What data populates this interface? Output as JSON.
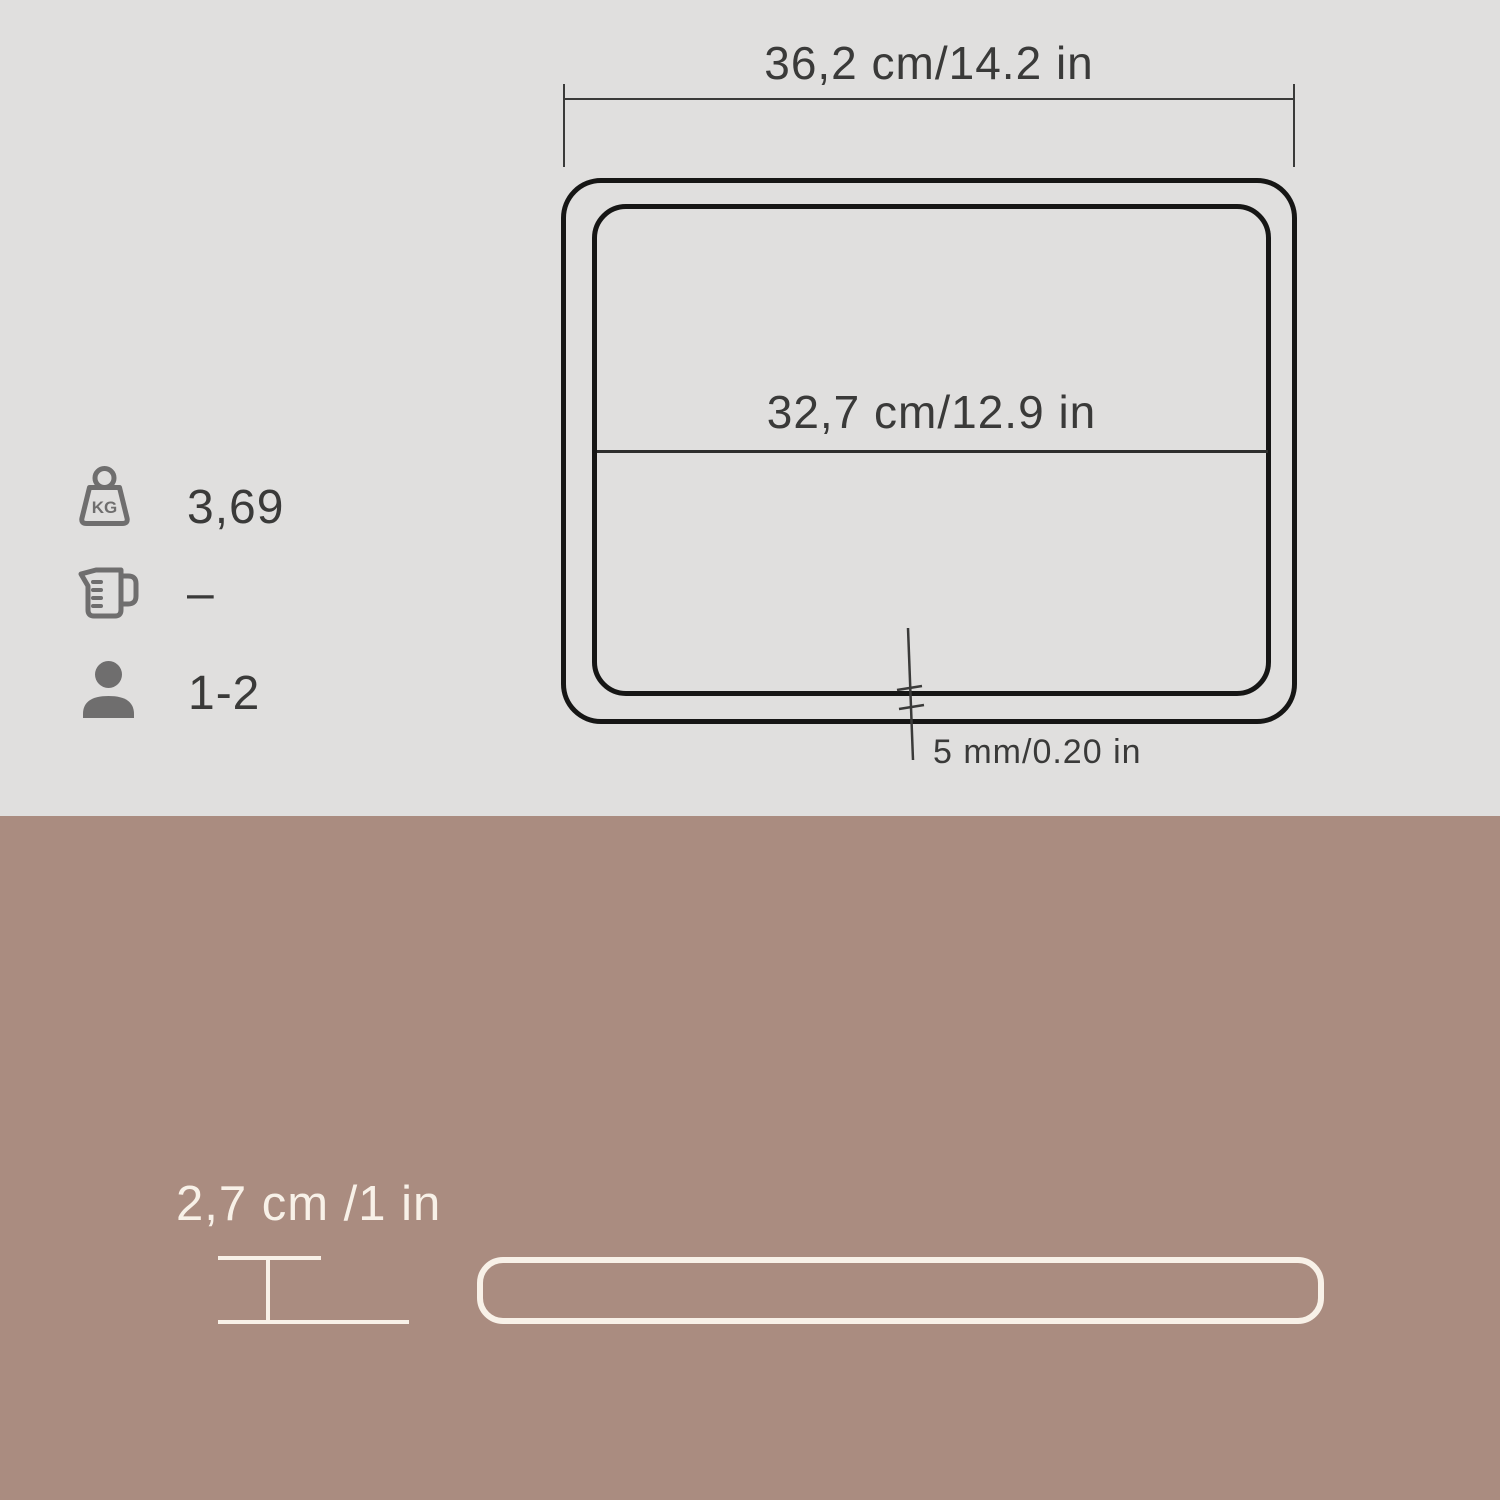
{
  "colors": {
    "top_bg": "#e0dfde",
    "bottom_bg": "#aa8c80",
    "text_dark": "#3a3a39",
    "dim_line": "#3a3a39",
    "tray_stroke": "#161615",
    "icon_gray": "#6f6e6e",
    "cream": "#f8f1e8"
  },
  "top_view": {
    "outer_width_label": "36,2 cm/14.2 in",
    "inner_width_label": "32,7 cm/12.9 in",
    "thickness_label": "5 mm/0.20 in"
  },
  "specs": {
    "weight": {
      "icon": "weight-kg-icon",
      "icon_text": "KG",
      "value": "3,69"
    },
    "capacity": {
      "icon": "measuring-jug-icon",
      "value": "–"
    },
    "servings": {
      "icon": "person-icon",
      "value": "1-2"
    }
  },
  "side_view": {
    "height_label": "2,7 cm /1 in"
  }
}
